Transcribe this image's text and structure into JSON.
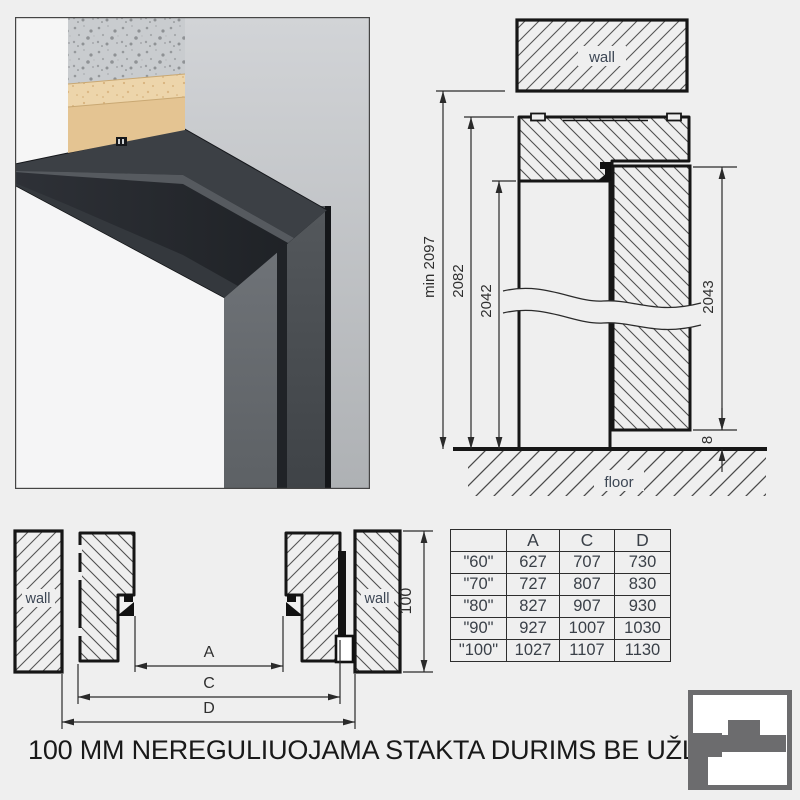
{
  "caption": "100 MM NEREGULIUOJAMA STAKTA DURIMS BE UŽLAIDOS",
  "vertical_section": {
    "wall_label": "wall",
    "floor_label": "floor",
    "dims": {
      "min_total": "min 2097",
      "frame": "2082",
      "opening": "2042",
      "leaf": "2043",
      "floor_gap": "8"
    }
  },
  "horizontal_section": {
    "left_wall_label": "wall",
    "right_wall_label": "wall",
    "dims": {
      "depth": "100",
      "a": "A",
      "c": "C",
      "d": "D"
    }
  },
  "size_table": {
    "columns": [
      "",
      "A",
      "C",
      "D"
    ],
    "rows": [
      {
        "size": "\"60\"",
        "a": "627",
        "c": "707",
        "d": "730"
      },
      {
        "size": "\"70\"",
        "a": "727",
        "c": "807",
        "d": "830"
      },
      {
        "size": "\"80\"",
        "a": "827",
        "c": "907",
        "d": "930"
      },
      {
        "size": "\"90\"",
        "a": "927",
        "c": "1007",
        "d": "1030"
      },
      {
        "size": "\"100\"",
        "a": "1027",
        "c": "1107",
        "d": "1130"
      }
    ]
  },
  "logo_color": "#6c6c6e"
}
